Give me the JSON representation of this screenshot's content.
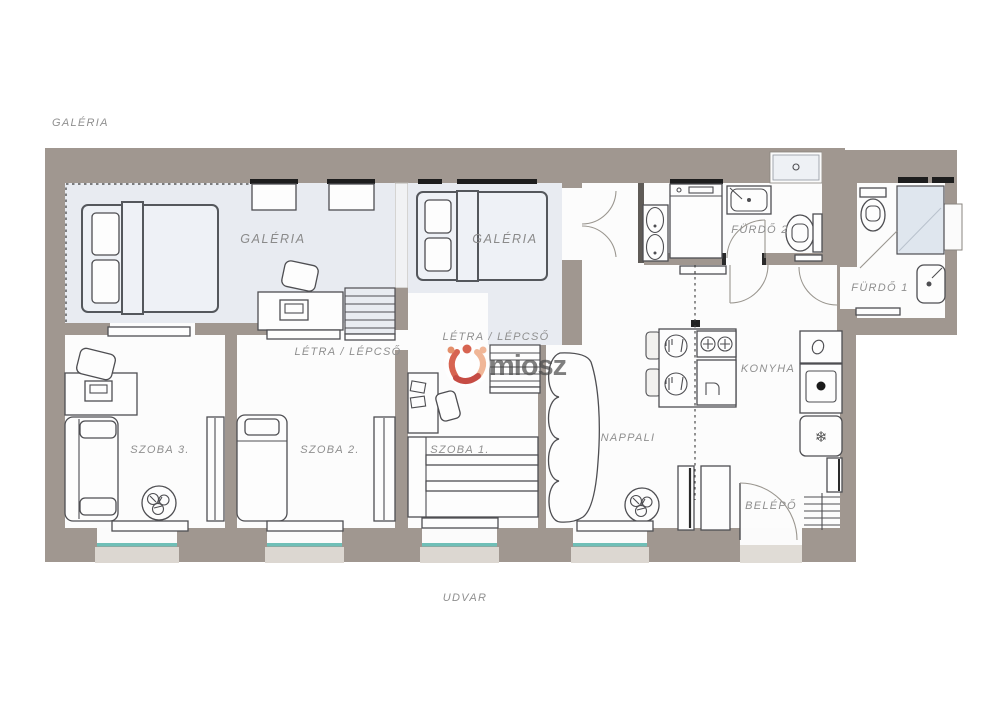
{
  "page": {
    "title_outside_top": "GALÉRIA",
    "title_outside_bottom": "UDVAR"
  },
  "rooms": {
    "galeria_left": "GALÉRIA",
    "galeria_center": "GALÉRIA",
    "ladder_left": "LÉTRA / LÉPCSŐ",
    "ladder_center": "LÉTRA / LÉPCSŐ",
    "szoba1": "SZOBA 1.",
    "szoba2": "SZOBA 2.",
    "szoba3": "SZOBA 3.",
    "nappali": "NAPPALI",
    "konyha": "KONYHA",
    "furdo1": "FÜRDŐ 1",
    "furdo2": "FÜRDŐ 2",
    "belepo": "BELÉPŐ"
  },
  "watermark": {
    "text": "miosz"
  },
  "icons": {
    "snowflake": "❄"
  },
  "colors": {
    "wall": "#a09790",
    "window_sill": "#dcd7d1",
    "gallery_overlay": "#e8ebf1",
    "window_glass": "#6fbfb7",
    "label_text": "#8f8f8f",
    "watermark_red": "#c8463b",
    "watermark_orange": "#e2845c",
    "watermark_salmon": "#efaf8d",
    "watermark_text": "#4a4a4a"
  }
}
